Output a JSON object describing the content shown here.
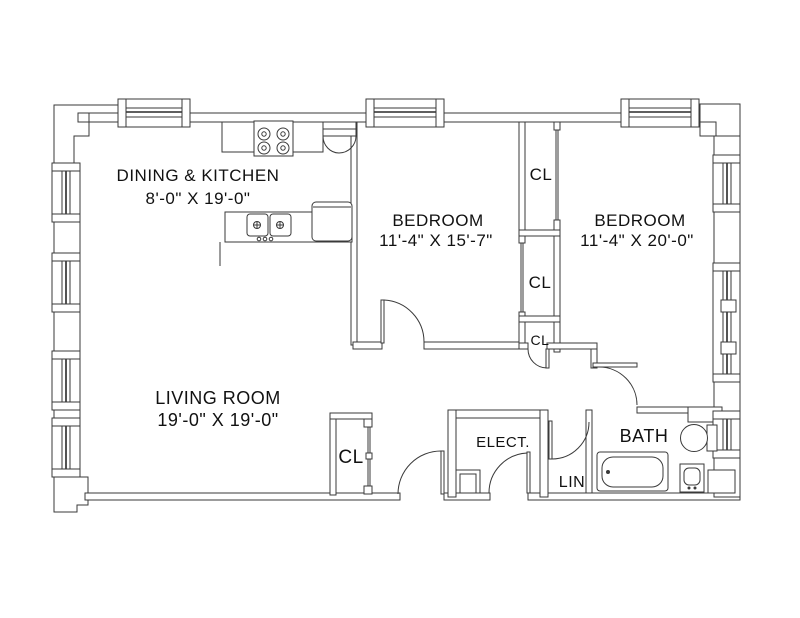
{
  "title": "Two-bedroom apartment floor plan",
  "colors": {
    "background": "#ffffff",
    "line": "#3a3a3a",
    "text": "#111111"
  },
  "rooms": {
    "dining_kitchen": {
      "label": "DINING & KITCHEN",
      "dimensions": "8'-0\" X 19'-0\""
    },
    "bedroom_left": {
      "label": "BEDROOM",
      "dimensions": "11'-4\" X 15'-7\""
    },
    "bedroom_right": {
      "label": "BEDROOM",
      "dimensions": "11'-4\" X 20'-0\""
    },
    "living_room": {
      "label": "LIVING ROOM",
      "dimensions": "19'-0\" X 19'-0\""
    },
    "bath": {
      "label": "BATH"
    },
    "electrical": {
      "label": "ELECT."
    },
    "linen": {
      "label": "LIN"
    },
    "closet_top": {
      "label": "CL"
    },
    "closet_middle": {
      "label": "CL"
    },
    "closet_bottom": {
      "label": "CL"
    },
    "closet_living": {
      "label": "CL"
    }
  }
}
